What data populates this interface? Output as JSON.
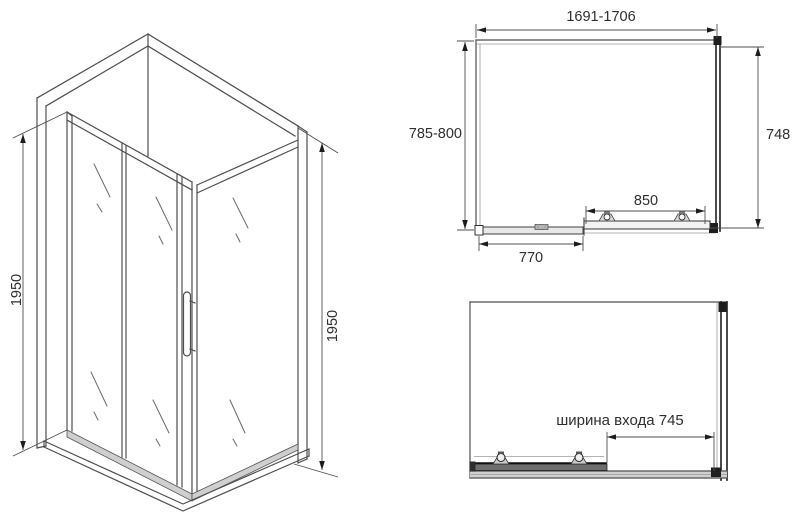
{
  "colors": {
    "line": "#4f4f4f",
    "dark_profile": "#222222",
    "dimension_text": "#2e2e2e",
    "track_fill": "#cfcfcf",
    "background": "#ffffff"
  },
  "isometric_view": {
    "height_left": "1950",
    "height_right": "1950"
  },
  "plan_view": {
    "overall_width": "1691-1706",
    "depth": "785-800",
    "side_depth": "748",
    "door_width": "850",
    "fixed_panel_width": "770"
  },
  "front_view": {
    "entrance_width": "ширина входа 745"
  }
}
